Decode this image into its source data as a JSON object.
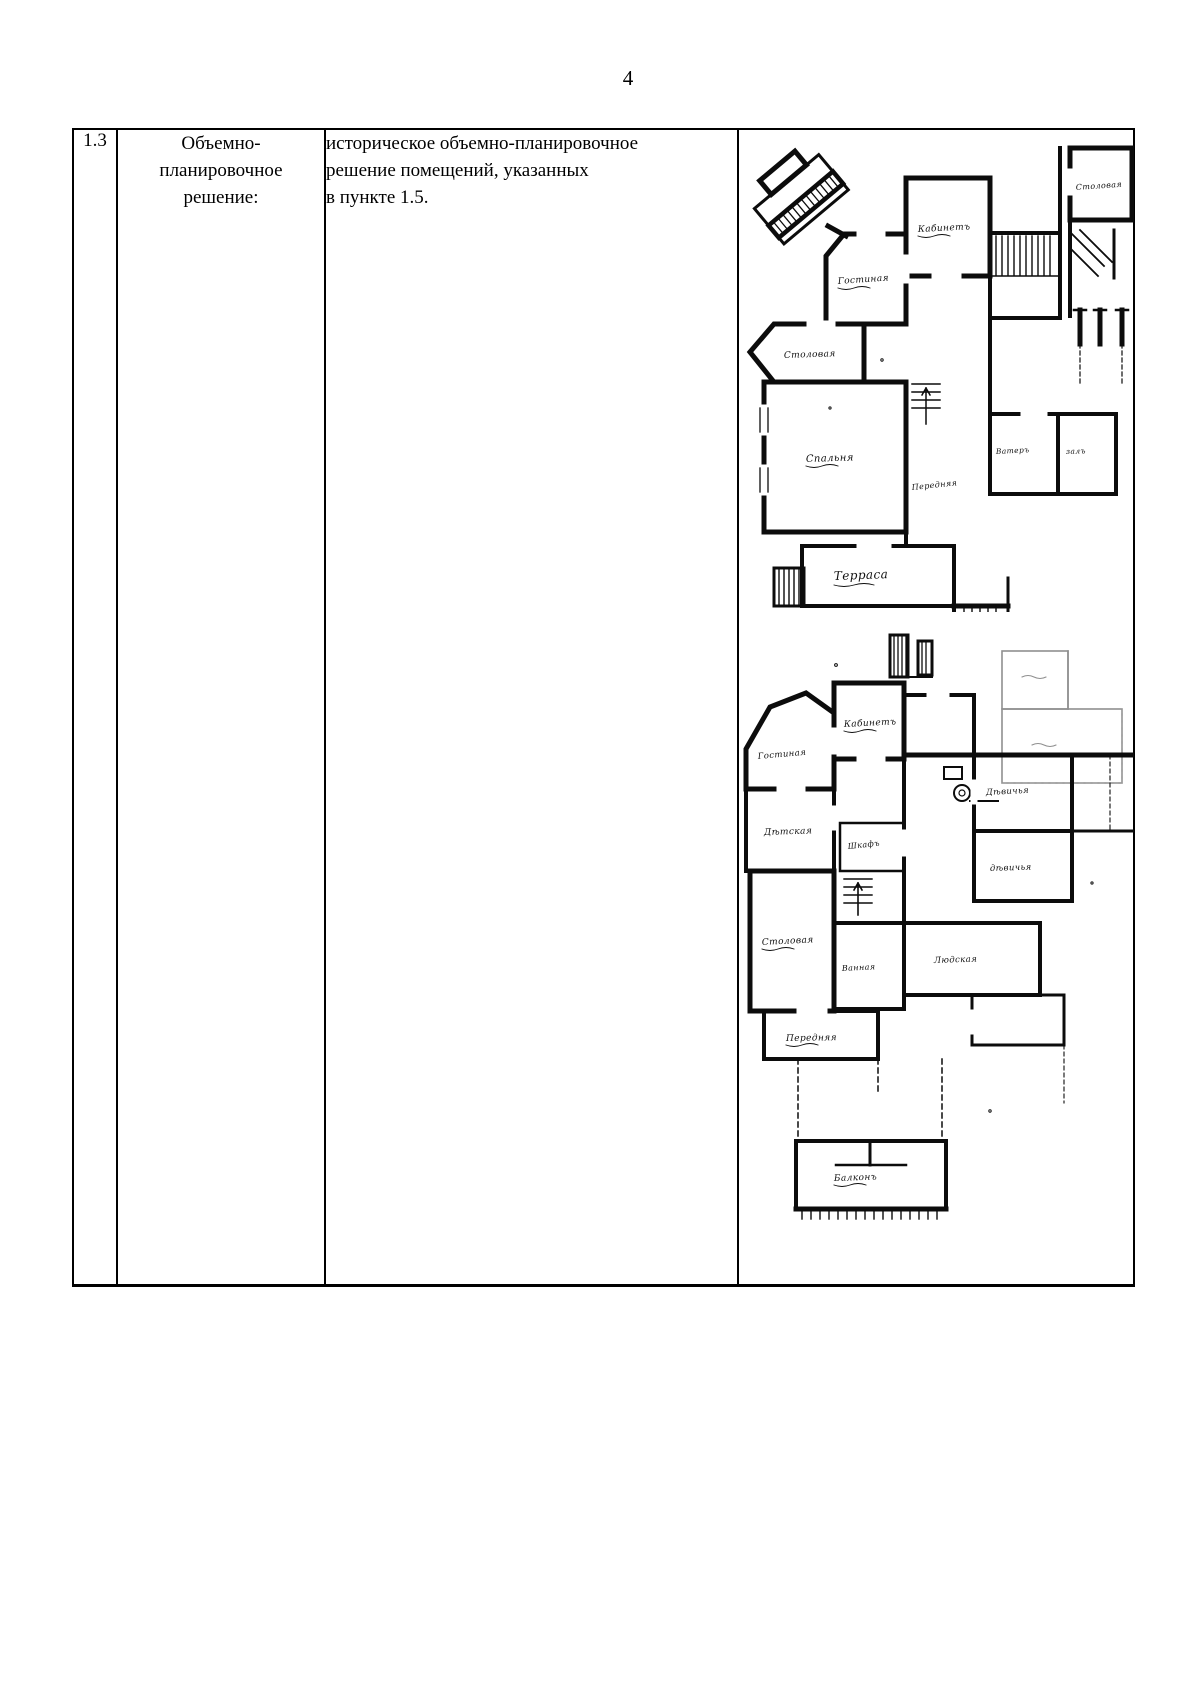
{
  "page_number": "4",
  "colors": {
    "ink": "#000000",
    "paper": "#ffffff"
  },
  "table": {
    "row_number": "1.3",
    "parameter": {
      "lines": [
        "Объемно-",
        "планировочное",
        "решение:"
      ]
    },
    "value": {
      "lines": [
        "историческое объемно-планировочное",
        "решение помещений, указанных",
        "в пункте 1.5."
      ]
    },
    "plans": {
      "plan1": {
        "labels": {
          "stolovaya_tr": "Столовая",
          "kabinet": "Кабинетъ",
          "gostinaya": "Гостиная",
          "stolovaya": "Столовая",
          "spalnya": "Спальня",
          "perednyaya": "Передняя",
          "vater": "Ватеръ",
          "zal": "залъ",
          "terrasa": "Терраса"
        }
      },
      "plan2": {
        "labels": {
          "kabinet": "Кабинетъ",
          "gostinaya": "Гостиная",
          "detskaya": "Дѣтская",
          "shkaf": "Шкафъ",
          "devichya1": "Дѣвичья",
          "devichya2": "дѣвичья",
          "stolovaya": "Столовая",
          "vannaya": "Ванная",
          "lyudskaya": "Людская",
          "perednyaya": "Передняя",
          "balkon": "Балконъ"
        }
      }
    }
  }
}
